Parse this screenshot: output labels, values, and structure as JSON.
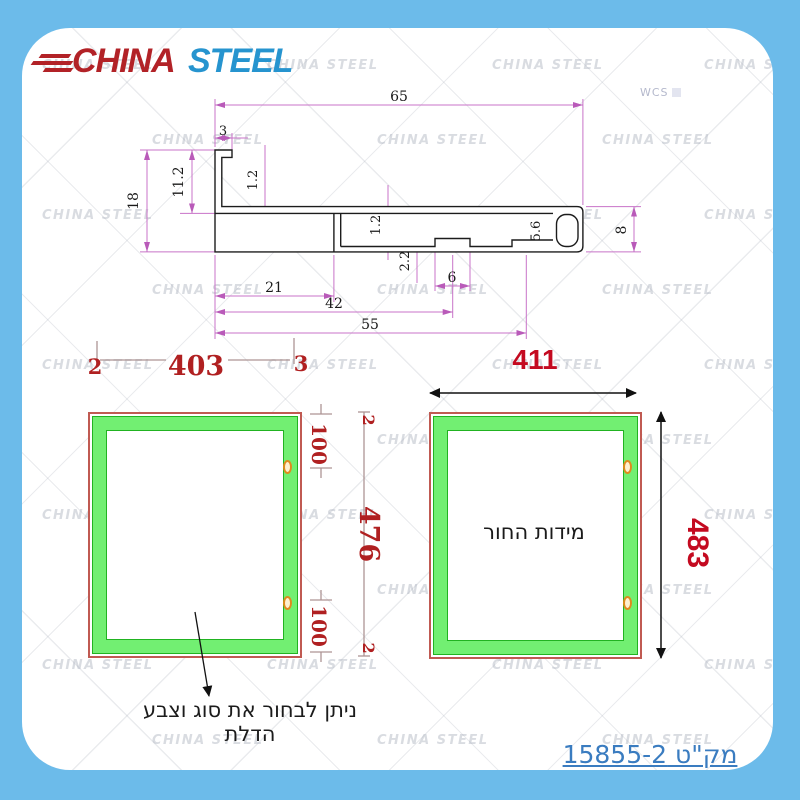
{
  "logo": {
    "word1": "CHINA",
    "word2": "STEEL",
    "color1": "#b22227",
    "color2": "#2694cf"
  },
  "watermark_text": "CHINA STEEL",
  "wcs": "WCS",
  "profile_dims": {
    "top_width": "65",
    "notch_width": "3",
    "leg_thickness": "1.2",
    "height_to_web": "11.2",
    "total_height": "18",
    "web_thickness": "1.2",
    "bottom_21": "21",
    "bottom_42": "42",
    "bottom_55": "55",
    "boss_depth": "2.2",
    "boss_width": "6",
    "slot_height": "5.6",
    "right_height": "8"
  },
  "left_panel_dims": {
    "gap_left": "2",
    "width": "403",
    "gap_right": "3",
    "side_gap_top": "2",
    "hole_top": "100",
    "height": "476",
    "hole_bottom": "100",
    "side_gap_bottom": "2"
  },
  "right_panel": {
    "width": "411",
    "height": "483",
    "inner_label": "מידות החור"
  },
  "caption": "ניתן לבחור  את סוג וצבע הדלת",
  "sku": "מק\"ט 15855-2",
  "colors": {
    "page_border": "#6cbbea",
    "dim_line": "#c873c8",
    "red_dim_serif": "#b02021",
    "red_dim_sans": "#c40a20",
    "panel_border": "#c05a52",
    "green_band": "#72ef72",
    "green_edge": "#21b321",
    "hole": "#e08a1e",
    "link": "#3a7cc0"
  }
}
